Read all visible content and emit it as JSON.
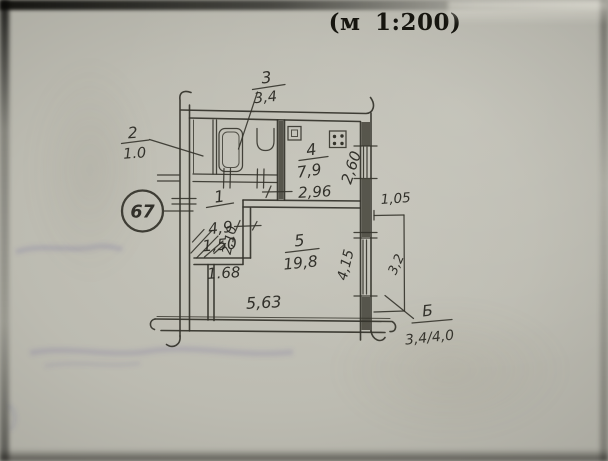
{
  "scale_note": "(м 1:200)",
  "plan": {
    "apartment_number": "67",
    "rooms": [
      {
        "num": "1",
        "area": "4,9"
      },
      {
        "num": "2",
        "area": "1.0"
      },
      {
        "num": "3",
        "area": "3,4"
      },
      {
        "num": "4",
        "area": "7,9"
      },
      {
        "num": "5",
        "area": "19,8"
      }
    ],
    "balcony": {
      "label": "Б",
      "area": "3,4/4,0"
    },
    "dimensions": {
      "kitchen_width": "2,96",
      "kitchen_depth": "2,60",
      "balcony_offset": "1,05",
      "balcony_side": "3,2",
      "living_depth": "4,15",
      "hall_passage": "2,10",
      "closet_width": "1,50",
      "lower_width": "1.68",
      "total_width": "5,63"
    }
  }
}
